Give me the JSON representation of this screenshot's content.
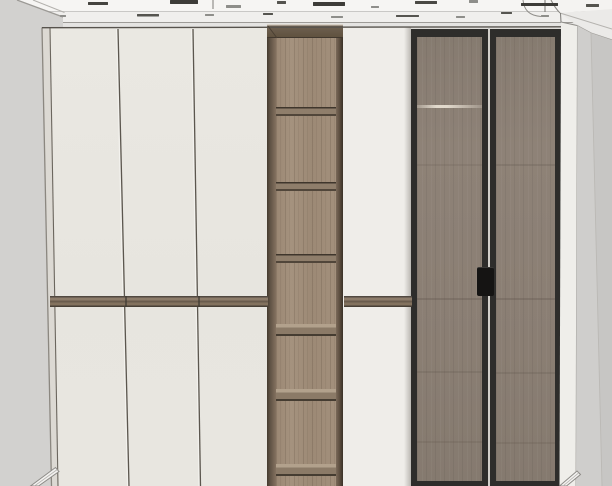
{
  "meta": {
    "title": "Wardrobe elevation 3D render",
    "canvas_width": 612,
    "canvas_height": 486
  },
  "palette": {
    "wall": "#d2d1cf",
    "ceiling": "#f6f5f3",
    "cornice": "#f0efed",
    "door_cream": "#eae8e2",
    "wood_face": "#a08d79",
    "wood_dark": "#5f5244",
    "glass": "#8a7e73",
    "glass_frame": "#2e2d2b",
    "panel_white": "#efede9",
    "handle_black": "#151413",
    "divider_wood": "#8d7c6a"
  },
  "scene": {
    "wall": {
      "label": "room wall"
    },
    "ceiling": {
      "label": "ceiling with crown molding",
      "dashes": [
        {
          "x": 88,
          "y": 2,
          "w": 20,
          "h": 3,
          "c": "#45443f"
        },
        {
          "x": 170,
          "y": 0,
          "w": 28,
          "h": 4,
          "c": "#3d3c38"
        },
        {
          "x": 226,
          "y": 5,
          "w": 15,
          "h": 3,
          "c": "#8e8e8a"
        },
        {
          "x": 277,
          "y": 1,
          "w": 9,
          "h": 3,
          "c": "#55544f"
        },
        {
          "x": 313,
          "y": 2,
          "w": 32,
          "h": 4,
          "c": "#3d3c38"
        },
        {
          "x": 371,
          "y": 6,
          "w": 8,
          "h": 2,
          "c": "#8e8e8a"
        },
        {
          "x": 415,
          "y": 1,
          "w": 22,
          "h": 3,
          "c": "#4a4944"
        },
        {
          "x": 469,
          "y": 0,
          "w": 9,
          "h": 3,
          "c": "#8e8e8a"
        },
        {
          "x": 521,
          "y": 3,
          "w": 37,
          "h": 3,
          "c": "#3d3c38"
        },
        {
          "x": 586,
          "y": 4,
          "w": 13,
          "h": 3,
          "c": "#55544f"
        },
        {
          "x": 60,
          "y": 15,
          "w": 6,
          "h": 2,
          "c": "#8e8e8a"
        },
        {
          "x": 137,
          "y": 14,
          "w": 22,
          "h": 2.5,
          "c": "#55544f"
        },
        {
          "x": 205,
          "y": 14,
          "w": 9,
          "h": 2,
          "c": "#8e8e8a"
        },
        {
          "x": 263,
          "y": 13,
          "w": 10,
          "h": 2,
          "c": "#55544f"
        },
        {
          "x": 331,
          "y": 16,
          "w": 12,
          "h": 2,
          "c": "#8e8e8a"
        },
        {
          "x": 396,
          "y": 15,
          "w": 23,
          "h": 2,
          "c": "#55544f"
        },
        {
          "x": 456,
          "y": 16,
          "w": 9,
          "h": 2,
          "c": "#8e8e8a"
        },
        {
          "x": 501,
          "y": 12,
          "w": 11,
          "h": 2,
          "c": "#55544f"
        },
        {
          "x": 541,
          "y": 15,
          "w": 8,
          "h": 2,
          "c": "#8e8e8a"
        }
      ]
    },
    "wardrobe": {
      "label": "full-height built-in wardrobe",
      "left_doors": {
        "label": "cream hinged doors, three columns, upper and lower banks",
        "columns": 3,
        "split_y": 300,
        "gap_lines": [
          {
            "x_top": 118,
            "x_bottom": 129
          },
          {
            "x_top": 193,
            "x_bottom": 200.5
          }
        ],
        "divider_notches": [
          75,
          148
        ]
      },
      "shelf_column": {
        "label": "open walnut shelf tower",
        "shelf_count": 6,
        "shelves": [
          {
            "y": 107,
            "view": "under"
          },
          {
            "y": 182,
            "view": "under"
          },
          {
            "y": 254,
            "view": "under"
          },
          {
            "y": 324,
            "view": "top"
          },
          {
            "y": 389,
            "view": "top"
          },
          {
            "y": 464,
            "view": "top"
          }
        ]
      },
      "mid_panel": {
        "label": "cream filler door"
      },
      "glass_door_left": {
        "label": "smoked glass framed door",
        "lines": [
          {
            "y": 104,
            "t": "light"
          },
          {
            "y": 163,
            "t": "dark",
            "o": 0.16
          },
          {
            "y": 297,
            "t": "dark",
            "o": 0.3
          },
          {
            "y": 370,
            "t": "dark",
            "o": 0.2
          },
          {
            "y": 440,
            "t": "dark",
            "o": 0.18
          }
        ]
      },
      "glass_door_right": {
        "label": "smoked glass framed door",
        "lines": [
          {
            "y": 163,
            "t": "dark",
            "o": 0.22
          },
          {
            "y": 297,
            "t": "dark",
            "o": 0.3
          },
          {
            "y": 371,
            "t": "dark",
            "o": 0.2
          },
          {
            "y": 441,
            "t": "dark",
            "o": 0.18
          }
        ]
      },
      "handle": {
        "label": "black recessed pull handle"
      },
      "side_panel_right": {
        "label": "white end panel"
      }
    },
    "baseboard_left": {
      "label": "baseboard trim, lower left"
    },
    "baseboard_right": {
      "label": "baseboard trim, lower right"
    }
  }
}
